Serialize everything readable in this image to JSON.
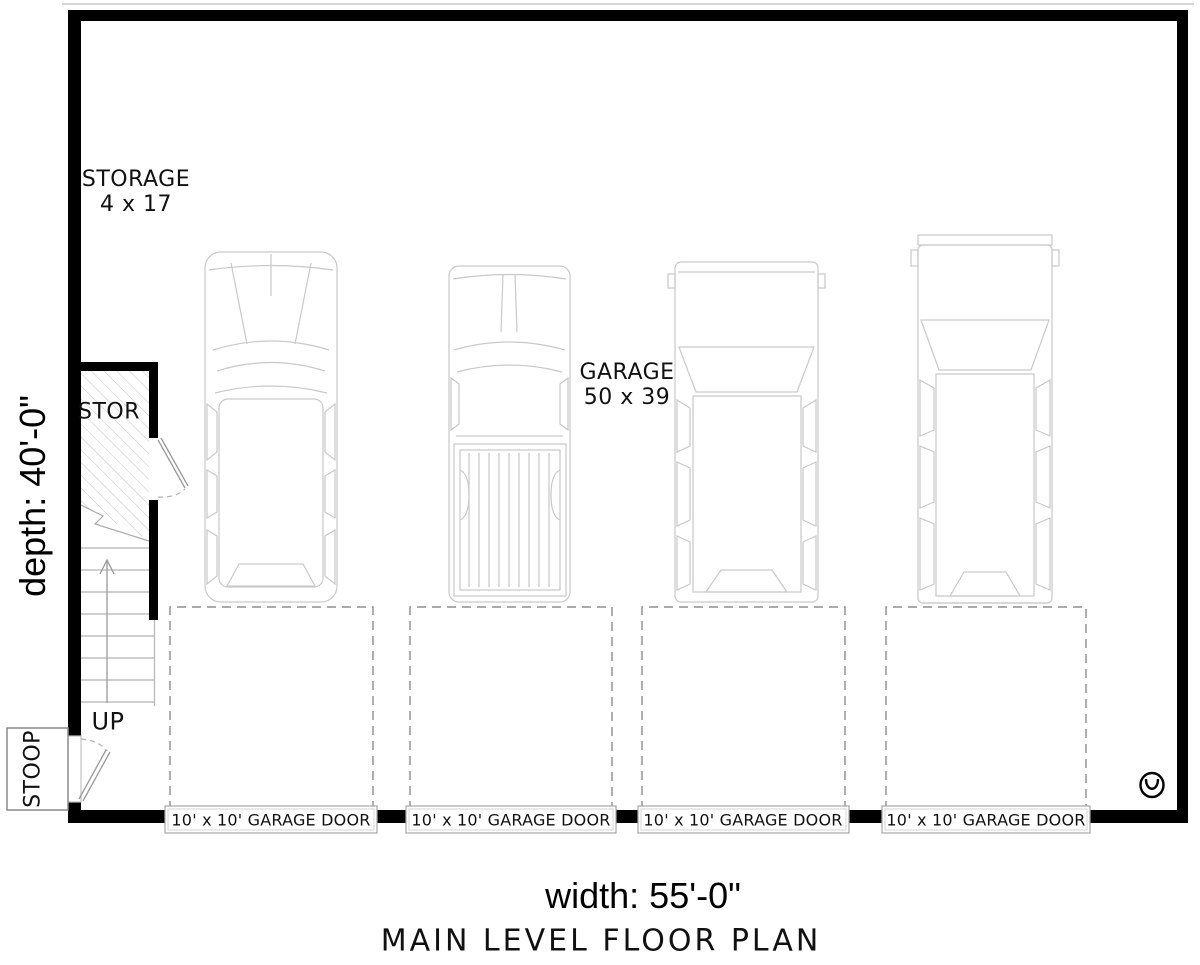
{
  "labels": {
    "storage_line1": "STORAGE",
    "storage_line2": "4 x 17",
    "garage_line1": "GARAGE",
    "garage_line2": "50 x 39",
    "stor": "STOR",
    "up": "UP",
    "stoop": "STOOP",
    "depth_dim": "depth: 40'-0\"",
    "width_dim": "width: 55'-0\"",
    "title": "MAIN LEVEL FLOOR PLAN"
  },
  "garage_doors": [
    {
      "label": "10' x 10' GARAGE DOOR"
    },
    {
      "label": "10' x 10' GARAGE DOOR"
    },
    {
      "label": "10' x 10' GARAGE DOOR"
    },
    {
      "label": "10' x 10' GARAGE DOOR"
    }
  ],
  "colors": {
    "wall": "#000000",
    "vehicle_line": "#c9c9c9",
    "dash_line": "#8d8d8d",
    "stair_line": "#b5b5b5",
    "door_leaf_line": "#9a9a9a",
    "door_box_line": "#a6a6a6",
    "background": "#ffffff"
  }
}
